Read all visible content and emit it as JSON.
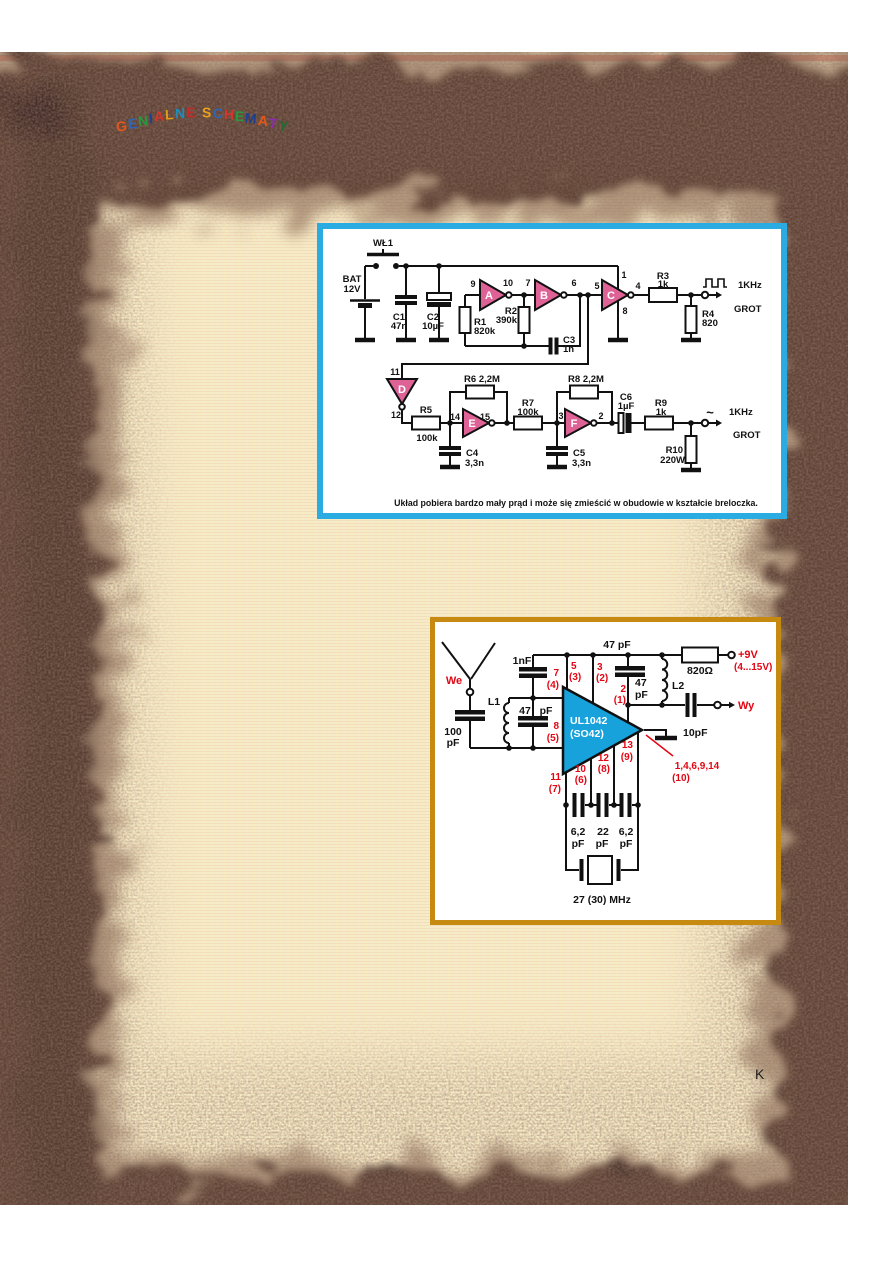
{
  "page": {
    "logo": "GENIALNE SCHEMATY",
    "logo_colors": [
      "#e2571b",
      "#2e66b5",
      "#27993f",
      "#1d3f8f",
      "#d9342b",
      "#e49b17",
      "#1d8fbf",
      "#c42a2a",
      "#000000",
      "#e8a21c",
      "#2e66b5",
      "#d9342b",
      "#27993f",
      "#1d3f8f",
      "#e2571b",
      "#8a2bb0",
      "#1f6b35"
    ],
    "page_marker": "K",
    "colors": {
      "paper": "#f6ebc8",
      "pink_line": "#f2a78c",
      "burnt_border_dark": "#3a2620",
      "burnt_border_mid": "#7b5742",
      "box1_border": "#2aabe2",
      "box2_border": "#c68a10",
      "inverter_fill": "#df6296",
      "ic_fill": "#17a2db",
      "red_label": "#e30613"
    }
  },
  "circuit1": {
    "caption": "Układ  pobiera bardzo mały prąd i może się zmieścić w obudowie w kształcie breloczka.",
    "labels": {
      "wl1": "WŁ1",
      "bat": "BAT",
      "bat_v": "12V",
      "c1": "C1",
      "c1_v": "47n",
      "c2": "C2",
      "c2_v": "10µF",
      "pin9": "9",
      "pin10": "10",
      "inv_a": "A",
      "r1": "R1",
      "r1_v": "820k",
      "r2": "R2",
      "r2_v": "390k",
      "pin7": "7",
      "pin6": "6",
      "inv_b": "B",
      "c3": "C3",
      "c3_v": "1n",
      "pin5": "5",
      "pin1": "1",
      "pin4": "4",
      "pin8": "8",
      "inv_c": "C",
      "r3": "R3",
      "r3_v": "1k",
      "freq_sq": "1KHz",
      "grot_sq": "GROT",
      "r4": "R4",
      "r4_v": "820",
      "pin11": "11",
      "pin12": "12",
      "inv_d": "D",
      "r5": "R5",
      "r5_v": "100k",
      "r6": "R6 2,2M",
      "pin14": "14",
      "pin15": "15",
      "inv_e": "E",
      "c4": "C4",
      "c4_v": "3,3n",
      "r7": "R7",
      "r7_v": "100k",
      "pin3": "3",
      "pin2": "2",
      "inv_f": "F",
      "c5": "C5",
      "c5_v": "3,3n",
      "r8": "R8 2,2M",
      "c6": "C6",
      "c6_v": "1µF",
      "r9": "R9",
      "r9_v": "1k",
      "tilde": "~",
      "freq_sin": "1KHz",
      "grot_sin": "GROT",
      "r10": "R10",
      "r10_v": "220W"
    }
  },
  "circuit2": {
    "labels": {
      "we": "We",
      "c100": "100",
      "c100_u": "pF",
      "l1": "L1",
      "c47l": "47",
      "c47l_u": "pF",
      "c1n": "1nF",
      "p7": "7",
      "p7b": "(4)",
      "p8": "8",
      "p8b": "(5)",
      "p5": "5",
      "p5b": "(3)",
      "p3": "3",
      "p3b": "(2)",
      "p2": "2",
      "p2b": "(1)",
      "ic_name": "UL1042",
      "ic_pkg": "(SO42)",
      "c47top": "47 pF",
      "c47r": "47",
      "c47r_u": "pF",
      "r820": "820Ω",
      "vplus": "+9V",
      "vrange": "(4...15V)",
      "l2": "L2",
      "wy": "Wy",
      "c10": "10pF",
      "p13": "13",
      "p13b": "(9)",
      "p12": "12",
      "p12b": "(8)",
      "p10": "10",
      "p10b": "(6)",
      "p11": "11",
      "p11b": "(7)",
      "common": "1,4,6,9,14",
      "common_b": "(10)",
      "cs1": "6,2",
      "cs1_u": "pF",
      "cs2": "22",
      "cs2_u": "pF",
      "cs3": "6,2",
      "cs3_u": "pF",
      "xtal": "27 (30) MHz"
    }
  }
}
